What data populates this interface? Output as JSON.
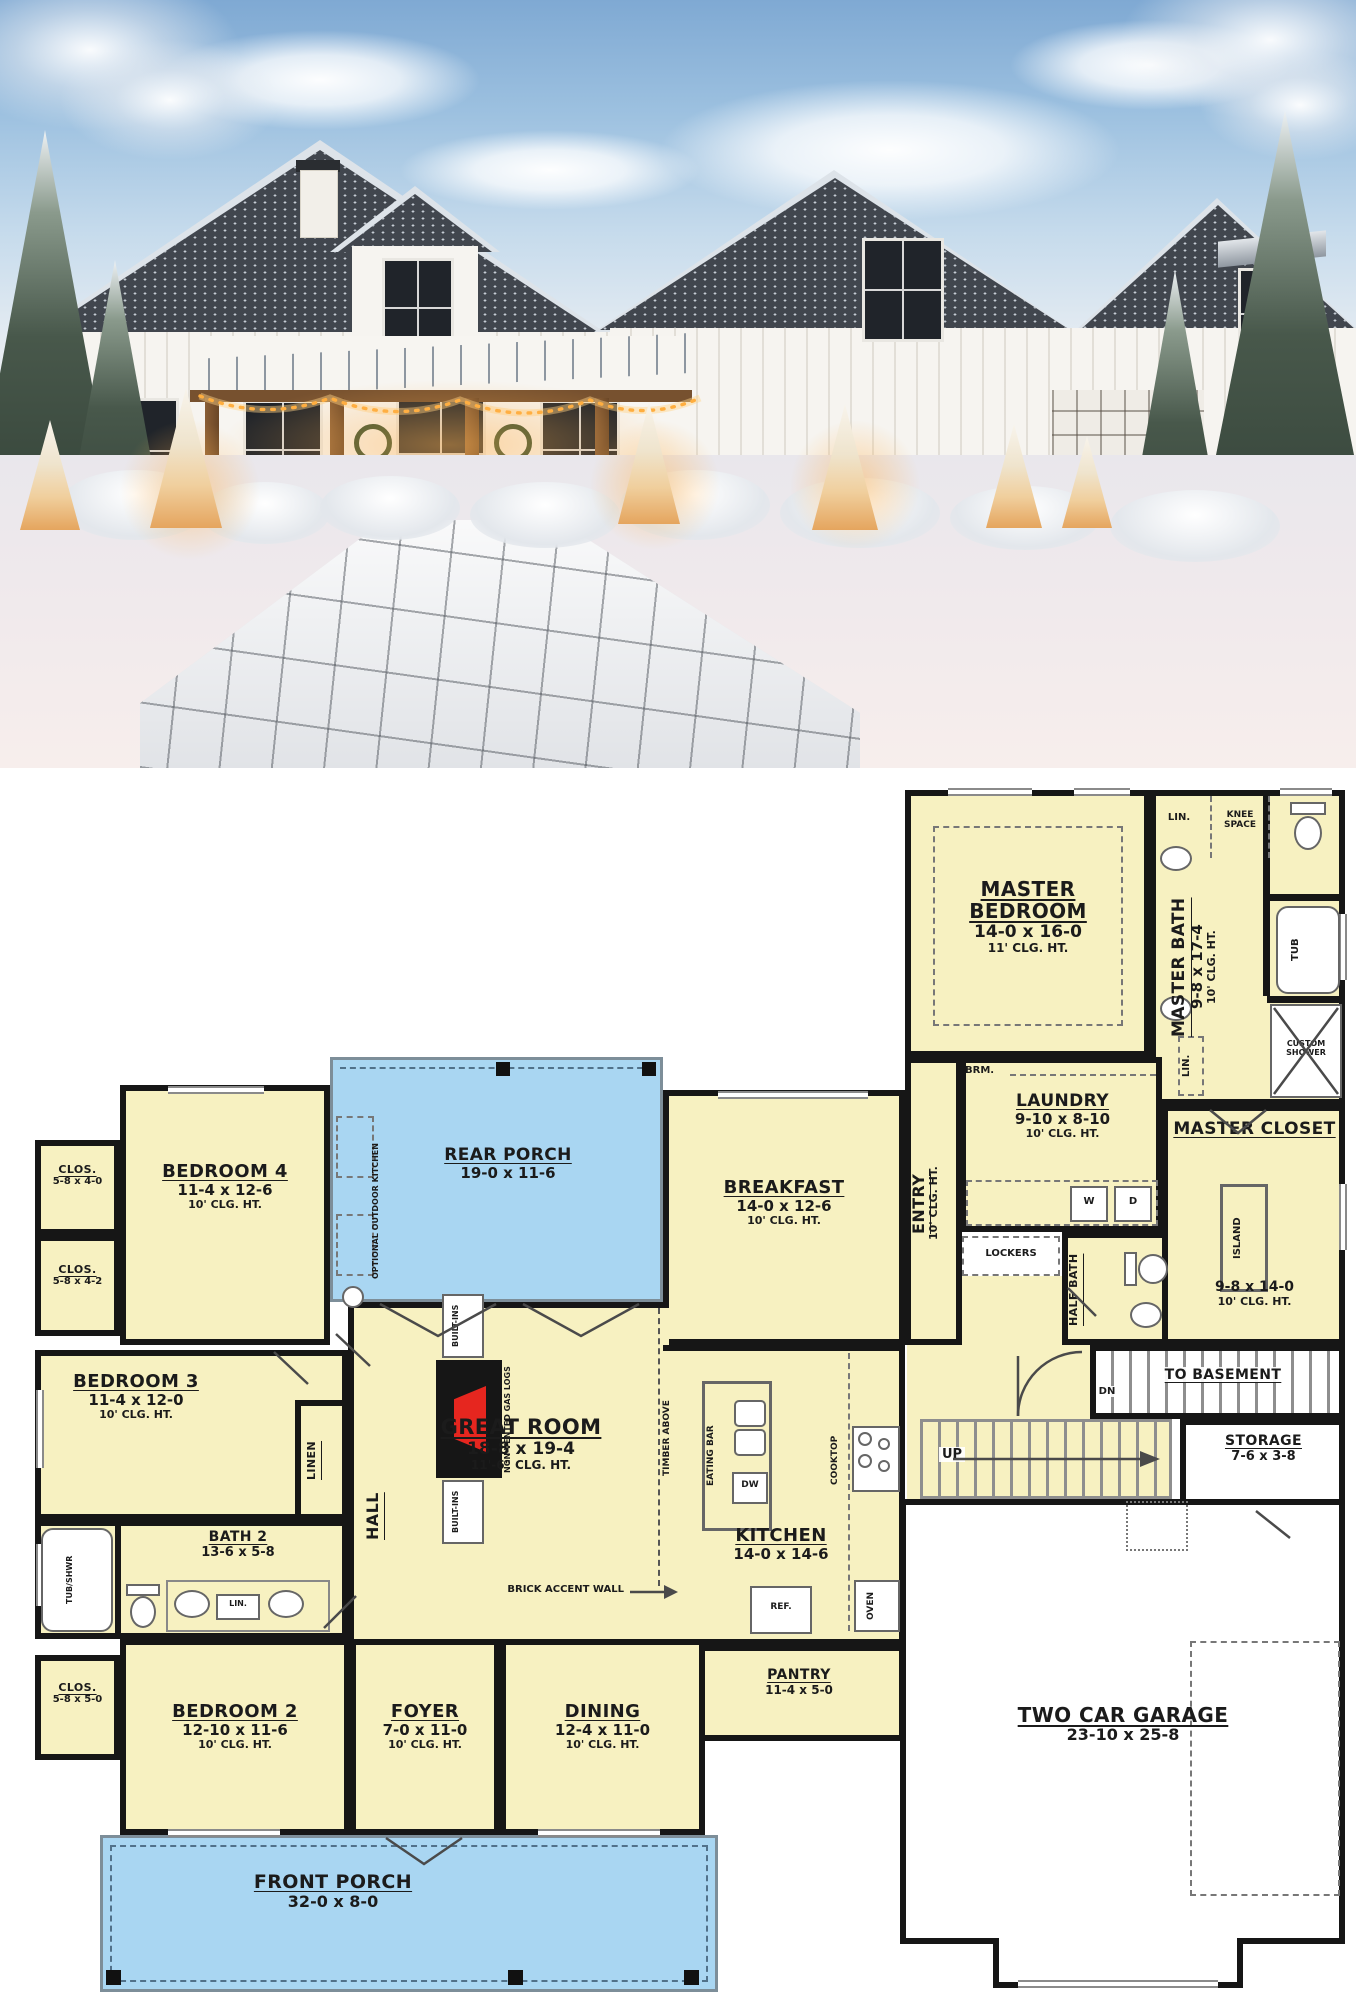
{
  "plan": {
    "colors": {
      "room_fill": "#f7f1c1",
      "porch_fill": "#a9d6f2",
      "wall": "#161616",
      "fireplace_red": "#e6261f",
      "stair_gray": "#8e8e8e"
    },
    "rooms": {
      "master_bedroom": {
        "name": "MASTER BEDROOM",
        "dims": "14-0 x 16-0",
        "clg": "11' CLG. HT."
      },
      "master_bath": {
        "name": "MASTER BATH",
        "dims": "9-8 x 17-4",
        "clg": "10' CLG. HT."
      },
      "master_closet": {
        "name": "MASTER CLOSET",
        "dims": "9-8 x 14-0",
        "clg": "10' CLG. HT."
      },
      "laundry": {
        "name": "LAUNDRY",
        "dims": "9-10 x 8-10",
        "clg": "10' CLG. HT."
      },
      "entry": {
        "name": "ENTRY",
        "clg": "10' CLG. HT."
      },
      "half_bath": {
        "name": "HALF BATH"
      },
      "to_basement": {
        "name": "TO BASEMENT"
      },
      "storage": {
        "name": "STORAGE",
        "dims": "7-6 x 3-8"
      },
      "garage": {
        "name": "TWO CAR GARAGE",
        "dims": "23-10 x 25-8"
      },
      "breakfast": {
        "name": "BREAKFAST",
        "dims": "14-0 x 12-6",
        "clg": "10' CLG. HT."
      },
      "rear_porch": {
        "name": "REAR PORCH",
        "dims": "19-0 x 11-6"
      },
      "bedroom4": {
        "name": "BEDROOM 4",
        "dims": "11-4 x 12-6",
        "clg": "10' CLG. HT."
      },
      "closet4": {
        "name": "CLOS.",
        "dims": "5-8 x 4-0"
      },
      "closet3": {
        "name": "CLOS.",
        "dims": "5-8 x 4-2"
      },
      "bedroom3": {
        "name": "BEDROOM 3",
        "dims": "11-4 x 12-0",
        "clg": "10' CLG. HT."
      },
      "great_room": {
        "name": "GREAT ROOM",
        "dims": "18-8 x 19-4",
        "clg": "11'-6\" CLG. HT."
      },
      "hall": {
        "name": "HALL"
      },
      "kitchen": {
        "name": "KITCHEN",
        "dims": "14-0 x 14-6"
      },
      "pantry": {
        "name": "PANTRY",
        "dims": "11-4 x 5-0"
      },
      "bath2": {
        "name": "BATH 2",
        "dims": "13-6 x 5-8"
      },
      "closet2": {
        "name": "CLOS.",
        "dims": "5-8 x 5-0"
      },
      "bedroom2": {
        "name": "BEDROOM 2",
        "dims": "12-10 x 11-6",
        "clg": "10' CLG. HT."
      },
      "foyer": {
        "name": "FOYER",
        "dims": "7-0 x 11-0",
        "clg": "10' CLG. HT."
      },
      "dining": {
        "name": "DINING",
        "dims": "12-4 x 11-0",
        "clg": "10' CLG. HT."
      },
      "front_porch": {
        "name": "FRONT PORCH",
        "dims": "32-0 x 8-0"
      }
    },
    "labels": {
      "lin_a": "LIN.",
      "knee_space": "KNEE SPACE",
      "tub": "TUB",
      "custom_shower": "CUSTOM SHOWER",
      "lin_b": "LIN.",
      "brm": "BRM.",
      "washer": "W",
      "dryer": "D",
      "lockers": "LOCKERS",
      "island": "ISLAND",
      "dn": "DN",
      "up": "UP",
      "linen": "LINEN",
      "tub_shwr": "TUB/SHWR",
      "lin_c": "LIN.",
      "built_ins": "BUILT-INS",
      "gas_logs": "NON-VENTED GAS LOGS",
      "timber_above": "TIMBER ABOVE",
      "brick_accent": "BRICK ACCENT WALL",
      "outdoor_kitchen": "OPTIONAL OUTDOOR KITCHEN",
      "eating_bar": "EATING BAR",
      "dw": "DW",
      "cooktop": "COOKTOP",
      "oven": "OVEN",
      "ref": "REF."
    }
  }
}
